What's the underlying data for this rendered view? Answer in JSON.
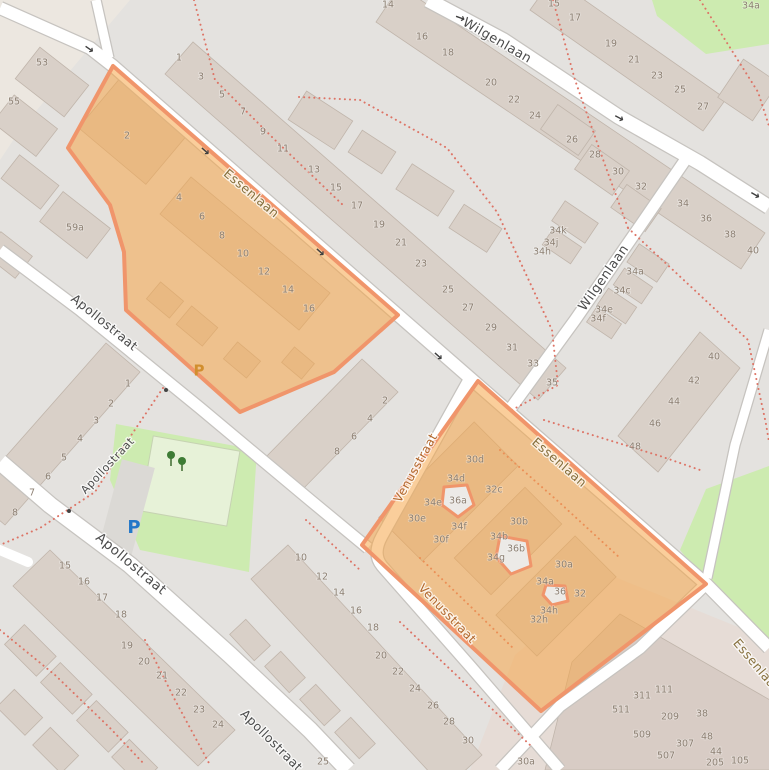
{
  "map": {
    "colors": {
      "background": "#e4e2df",
      "highlight_fill": "rgba(246,166,73,0.55)",
      "highlight_stroke": "#f0956b",
      "highlight_building_fill": "#eceae7",
      "park_green": "#cdebb0",
      "road_white": "#ffffff",
      "building_gray": "#d9d0c8",
      "dashed_path_red": "#dd7466",
      "parking_blue": "#2478c8",
      "parking_orange": "#d18e2e"
    },
    "street_labels": [
      {
        "t": "Wilgenlaan",
        "x": 497,
        "y": 41,
        "rot": 30,
        "size": 13
      },
      {
        "t": "Wilgenlaan",
        "x": 604,
        "y": 278,
        "rot": -55,
        "size": 13
      },
      {
        "t": "Essenlaan",
        "x": 251,
        "y": 194,
        "rot": 40,
        "variant": "olive",
        "size": 12.5
      },
      {
        "t": "Essenlaan",
        "x": 559,
        "y": 463,
        "rot": 41,
        "variant": "olive",
        "size": 12.5
      },
      {
        "t": "Essenlaan",
        "x": 757,
        "y": 667,
        "rot": 50,
        "variant": "olive",
        "size": 12.5
      },
      {
        "t": "Apollostraat",
        "x": 104,
        "y": 323,
        "rot": 39,
        "size": 12.5
      },
      {
        "t": "Apollostraat",
        "x": 108,
        "y": 466,
        "rot": -47,
        "size": 11
      },
      {
        "t": "Apollostraat",
        "x": 131,
        "y": 564,
        "rot": 40,
        "size": 13.5
      },
      {
        "t": "Apollostraat",
        "x": 271,
        "y": 741,
        "rot": 45,
        "size": 12.5
      },
      {
        "t": "Venusstraat",
        "x": 416,
        "y": 468,
        "rot": -61,
        "variant": "orange",
        "size": 12
      },
      {
        "t": "Venusstraat",
        "x": 447,
        "y": 614,
        "rot": 46,
        "variant": "orange",
        "size": 12
      }
    ],
    "house_numbers": {
      "format": "[label, x, y]",
      "items": [
        [
          "53",
          42,
          63
        ],
        [
          "55",
          14,
          102
        ],
        [
          "59a",
          75,
          228
        ],
        [
          "1",
          179,
          58
        ],
        [
          "3",
          201,
          77
        ],
        [
          "5",
          222,
          95
        ],
        [
          "7",
          243,
          112
        ],
        [
          "9",
          263,
          132
        ],
        [
          "11",
          283,
          149
        ],
        [
          "13",
          314,
          170
        ],
        [
          "15",
          336,
          188
        ],
        [
          "17",
          357,
          206
        ],
        [
          "19",
          379,
          225
        ],
        [
          "21",
          401,
          243
        ],
        [
          "23",
          421,
          264
        ],
        [
          "25",
          448,
          290
        ],
        [
          "27",
          468,
          308
        ],
        [
          "29",
          491,
          328
        ],
        [
          "31",
          512,
          348
        ],
        [
          "33",
          533,
          364
        ],
        [
          "35",
          552,
          383
        ],
        [
          "14",
          388,
          5
        ],
        [
          "16",
          422,
          37
        ],
        [
          "18",
          448,
          53
        ],
        [
          "20",
          491,
          83
        ],
        [
          "22",
          514,
          100
        ],
        [
          "24",
          535,
          116
        ],
        [
          "26",
          572,
          140
        ],
        [
          "28",
          595,
          155
        ],
        [
          "30",
          618,
          172
        ],
        [
          "32",
          641,
          187
        ],
        [
          "34",
          683,
          204
        ],
        [
          "36",
          706,
          219
        ],
        [
          "38",
          730,
          235
        ],
        [
          "40",
          753,
          251
        ],
        [
          "15",
          554,
          4
        ],
        [
          "17",
          575,
          18
        ],
        [
          "19",
          611,
          44
        ],
        [
          "21",
          634,
          60
        ],
        [
          "23",
          657,
          76
        ],
        [
          "25",
          680,
          90
        ],
        [
          "27",
          703,
          107
        ],
        [
          "34a",
          751,
          6
        ],
        [
          "34k",
          558,
          231
        ],
        [
          "34j",
          551,
          243
        ],
        [
          "34h",
          542,
          252
        ],
        [
          "34a",
          635,
          272
        ],
        [
          "34c",
          622,
          291
        ],
        [
          "34e",
          604,
          310
        ],
        [
          "34f",
          598,
          319
        ],
        [
          "40",
          714,
          357
        ],
        [
          "42",
          694,
          381
        ],
        [
          "44",
          674,
          402
        ],
        [
          "46",
          655,
          424
        ],
        [
          "48",
          635,
          447
        ],
        [
          "2",
          127,
          136
        ],
        [
          "4",
          179,
          198
        ],
        [
          "6",
          202,
          217
        ],
        [
          "8",
          222,
          236
        ],
        [
          "10",
          243,
          254
        ],
        [
          "12",
          264,
          272
        ],
        [
          "14",
          288,
          290
        ],
        [
          "16",
          309,
          309
        ],
        [
          "2",
          385,
          401
        ],
        [
          "4",
          370,
          419
        ],
        [
          "6",
          354,
          437
        ],
        [
          "8",
          337,
          452
        ],
        [
          "1",
          128,
          384
        ],
        [
          "2",
          111,
          404
        ],
        [
          "3",
          96,
          421
        ],
        [
          "4",
          80,
          439
        ],
        [
          "5",
          64,
          458
        ],
        [
          "6",
          48,
          477
        ],
        [
          "7",
          32,
          493
        ],
        [
          "8",
          15,
          513
        ],
        [
          "15",
          65,
          566
        ],
        [
          "16",
          84,
          582
        ],
        [
          "17",
          102,
          598
        ],
        [
          "18",
          121,
          615
        ],
        [
          "19",
          127,
          646
        ],
        [
          "20",
          144,
          662
        ],
        [
          "21",
          162,
          676
        ],
        [
          "22",
          181,
          693
        ],
        [
          "23",
          199,
          710
        ],
        [
          "24",
          218,
          725
        ],
        [
          "10",
          301,
          558
        ],
        [
          "12",
          322,
          577
        ],
        [
          "14",
          339,
          593
        ],
        [
          "16",
          356,
          611
        ],
        [
          "18",
          373,
          628
        ],
        [
          "20",
          381,
          656
        ],
        [
          "22",
          398,
          672
        ],
        [
          "24",
          415,
          689
        ],
        [
          "26",
          433,
          706
        ],
        [
          "28",
          449,
          722
        ],
        [
          "30",
          468,
          741
        ],
        [
          "25",
          323,
          762
        ],
        [
          "30a",
          526,
          762
        ],
        [
          "30d",
          475,
          460
        ],
        [
          "34d",
          456,
          479
        ],
        [
          "32c",
          494,
          490
        ],
        [
          "36a",
          458,
          501
        ],
        [
          "34e",
          433,
          503
        ],
        [
          "30e",
          417,
          519
        ],
        [
          "34f",
          459,
          527
        ],
        [
          "30f",
          441,
          540
        ],
        [
          "30b",
          519,
          522
        ],
        [
          "34b",
          499,
          537
        ],
        [
          "36b",
          516,
          549
        ],
        [
          "34g",
          496,
          558
        ],
        [
          "30a",
          564,
          565
        ],
        [
          "34a",
          545,
          582
        ],
        [
          "36",
          560,
          592
        ],
        [
          "32",
          580,
          594
        ],
        [
          "34h",
          549,
          611
        ],
        [
          "32h",
          539,
          620
        ],
        [
          "311",
          642,
          696
        ],
        [
          "111",
          664,
          690
        ],
        [
          "511",
          621,
          710
        ],
        [
          "209",
          670,
          717
        ],
        [
          "38",
          702,
          714
        ],
        [
          "509",
          642,
          735
        ],
        [
          "307",
          685,
          744
        ],
        [
          "48",
          707,
          737
        ],
        [
          "507",
          666,
          756
        ],
        [
          "44",
          716,
          752
        ],
        [
          "205",
          715,
          763
        ],
        [
          "105",
          740,
          761
        ]
      ]
    },
    "oneway_arrows": [
      [
        89,
        49,
        35
      ],
      [
        460,
        18,
        20
      ],
      [
        619,
        118,
        28
      ],
      [
        755,
        195,
        30
      ],
      [
        205,
        151,
        42
      ],
      [
        320,
        252,
        42
      ],
      [
        438,
        356,
        42
      ]
    ],
    "parking": [
      {
        "label": "P",
        "x": 199,
        "y": 371,
        "variant": "orange"
      },
      {
        "label": "P",
        "x": 134,
        "y": 528,
        "variant": "blue"
      }
    ],
    "icons": {
      "oneway_glyph": "→",
      "tree_icon": "two dark-green trees in park"
    }
  }
}
